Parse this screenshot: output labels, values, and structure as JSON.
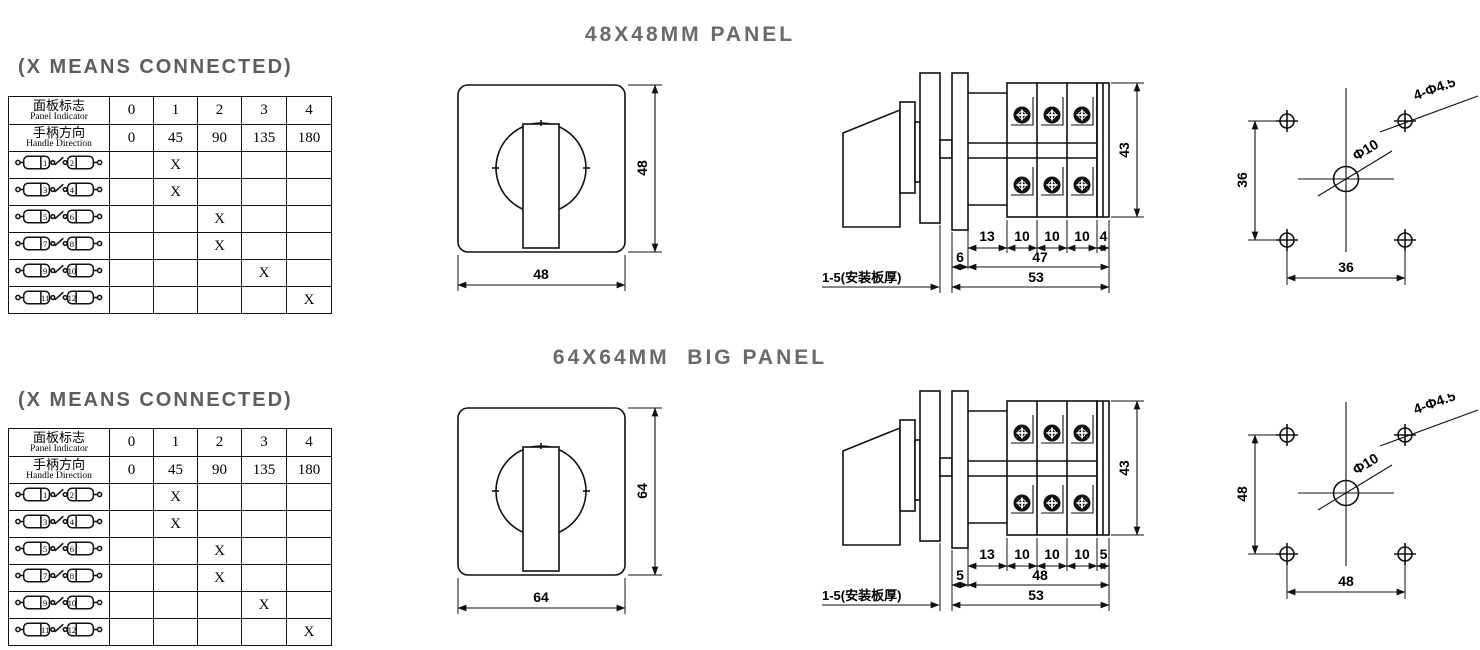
{
  "colors": {
    "line": "#111111",
    "title_gray": "#6a6a6a",
    "text": "#000000",
    "background": "#ffffff"
  },
  "sections": [
    {
      "panel_title": "48X48MM PANEL",
      "connected_note": "(X MEANS CONNECTED)",
      "table": {
        "header1_cn": "面板标志",
        "header1_en": "Panel Indicator",
        "header1_values": [
          "0",
          "1",
          "2",
          "3",
          "4"
        ],
        "header2_cn": "手柄方向",
        "header2_en": "Handle Direction",
        "header2_values": [
          "0",
          "45",
          "90",
          "135",
          "180"
        ],
        "rows": [
          {
            "left_terminal": "1",
            "right_terminal": "2",
            "marks": [
              "",
              "X",
              "",
              "",
              ""
            ]
          },
          {
            "left_terminal": "3",
            "right_terminal": "4",
            "marks": [
              "",
              "X",
              "",
              "",
              ""
            ]
          },
          {
            "left_terminal": "5",
            "right_terminal": "6",
            "marks": [
              "",
              "",
              "X",
              "",
              ""
            ]
          },
          {
            "left_terminal": "7",
            "right_terminal": "8",
            "marks": [
              "",
              "",
              "X",
              "",
              ""
            ]
          },
          {
            "left_terminal": "9",
            "right_terminal": "10",
            "marks": [
              "",
              "",
              "",
              "X",
              ""
            ]
          },
          {
            "left_terminal": "11",
            "right_terminal": "12",
            "marks": [
              "",
              "",
              "",
              "",
              "X"
            ]
          }
        ]
      },
      "front_view": {
        "width": "48",
        "height": "48"
      },
      "side_view": {
        "height": "43",
        "seg1": "13",
        "seg2": "10",
        "seg3": "10",
        "seg4": "10",
        "seg5": "4",
        "flange": "6",
        "body_depth": "47",
        "total_depth": "53",
        "plate_note": "1-5(安装板厚)"
      },
      "drill_view": {
        "vertical_pitch": "36",
        "horizontal_pitch": "36",
        "center_hole": "Φ10",
        "corner_holes": "4-Φ4.5"
      }
    },
    {
      "panel_title": "64X64MM  BIG PANEL",
      "connected_note": "(X MEANS CONNECTED)",
      "table": {
        "header1_cn": "面板标志",
        "header1_en": "Panel Indicator",
        "header1_values": [
          "0",
          "1",
          "2",
          "3",
          "4"
        ],
        "header2_cn": "手柄方向",
        "header2_en": "Handle Direction",
        "header2_values": [
          "0",
          "45",
          "90",
          "135",
          "180"
        ],
        "rows": [
          {
            "left_terminal": "1",
            "right_terminal": "2",
            "marks": [
              "",
              "X",
              "",
              "",
              ""
            ]
          },
          {
            "left_terminal": "3",
            "right_terminal": "4",
            "marks": [
              "",
              "X",
              "",
              "",
              ""
            ]
          },
          {
            "left_terminal": "5",
            "right_terminal": "6",
            "marks": [
              "",
              "",
              "X",
              "",
              ""
            ]
          },
          {
            "left_terminal": "7",
            "right_terminal": "8",
            "marks": [
              "",
              "",
              "X",
              "",
              ""
            ]
          },
          {
            "left_terminal": "9",
            "right_terminal": "10",
            "marks": [
              "",
              "",
              "",
              "X",
              ""
            ]
          },
          {
            "left_terminal": "11",
            "right_terminal": "12",
            "marks": [
              "",
              "",
              "",
              "",
              "X"
            ]
          }
        ]
      },
      "front_view": {
        "width": "64",
        "height": "64"
      },
      "side_view": {
        "height": "43",
        "seg1": "13",
        "seg2": "10",
        "seg3": "10",
        "seg4": "10",
        "seg5": "5",
        "flange": "5",
        "body_depth": "48",
        "total_depth": "53",
        "plate_note": "1-5(安装板厚)"
      },
      "drill_view": {
        "vertical_pitch": "48",
        "horizontal_pitch": "48",
        "center_hole": "Φ10",
        "corner_holes": "4-Φ4.5"
      }
    }
  ]
}
